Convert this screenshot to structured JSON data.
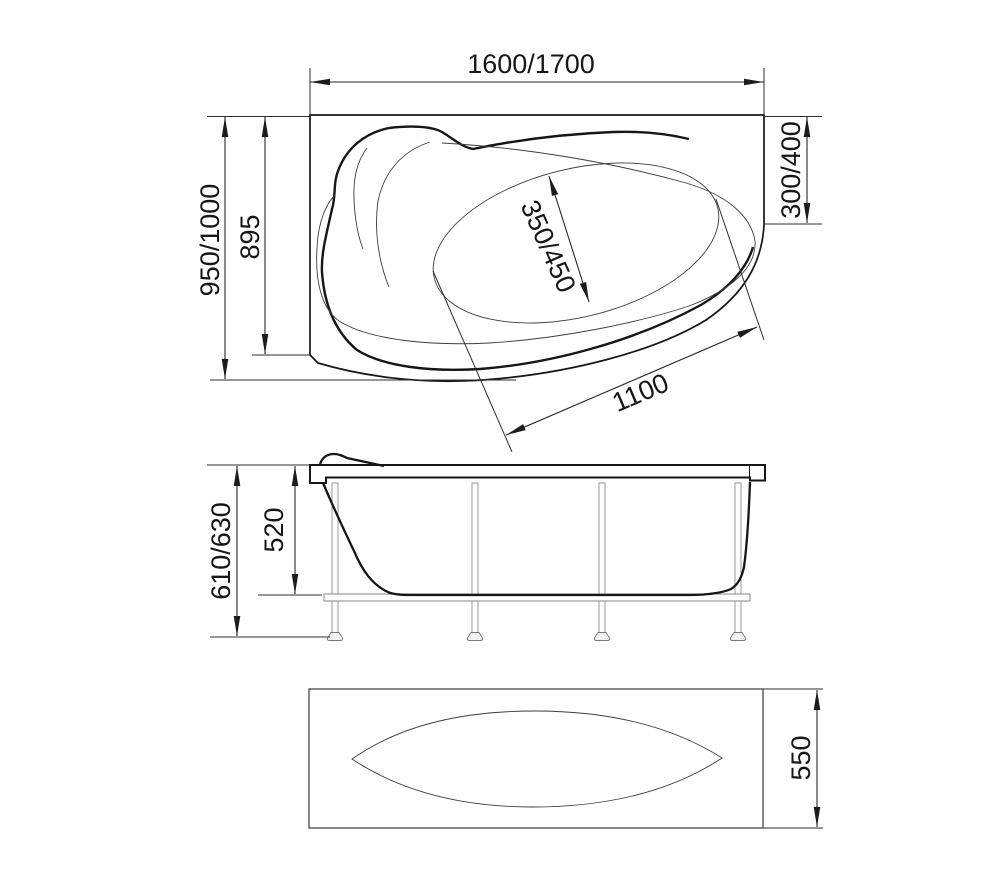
{
  "drawing": {
    "top_view": {
      "dim_width": "1600/1700",
      "dim_depth": "950/1000",
      "dim_depth_inner": "895",
      "dim_side": "300/400",
      "dim_basin": "350/450",
      "dim_diagonal": "1100"
    },
    "front_view": {
      "dim_height_total": "610/630",
      "dim_height_shell": "520"
    },
    "panel_view": {
      "dim_height": "550"
    },
    "colors": {
      "line": "#161616",
      "dimension_line": "#262626",
      "frame_gray": "#8f8f8f",
      "background": "#ffffff"
    }
  }
}
